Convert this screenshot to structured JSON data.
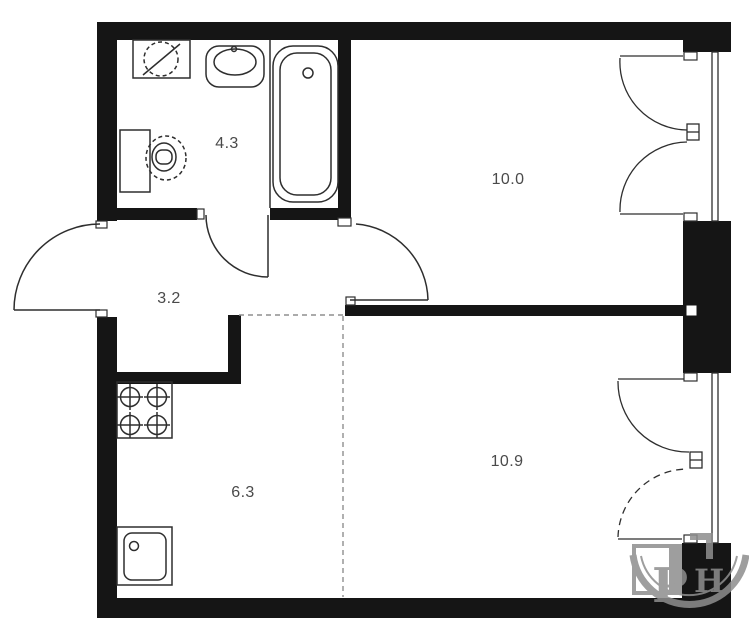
{
  "plan": {
    "rooms": [
      {
        "id": "bathroom",
        "area": "4.3"
      },
      {
        "id": "room-top-right",
        "area": "10.0"
      },
      {
        "id": "hallway",
        "area": "3.2"
      },
      {
        "id": "kitchen",
        "area": "6.3"
      },
      {
        "id": "room-bottom-right",
        "area": "10.9"
      }
    ],
    "watermark": {
      "letter1": "Р",
      "letter2": "Н"
    },
    "colors": {
      "wall": "#151515",
      "line": "#2e2e2e",
      "dashed_boundary": "#8f8f8f",
      "label_text": "#4a4a4a",
      "watermark": "#8e8e8e"
    }
  }
}
